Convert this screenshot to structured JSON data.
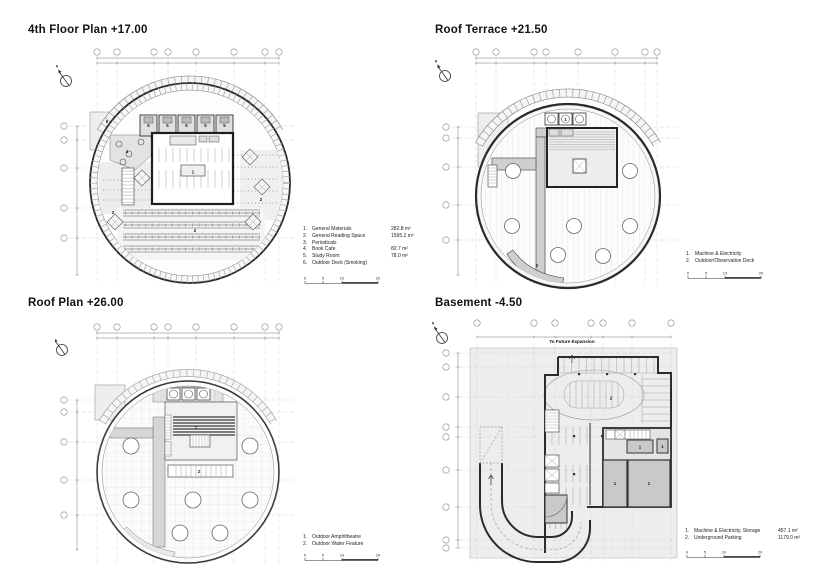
{
  "north": {
    "label": "N"
  },
  "plans": [
    {
      "title": "4th Floor Plan +17.00",
      "legend": [
        {
          "num": "1.",
          "label": "General Materials",
          "area": "282.8 m²"
        },
        {
          "num": "2.",
          "label": "General Reading Space",
          "area": "1595.2 m²"
        },
        {
          "num": "3.",
          "label": "Periodicals",
          "area": ""
        },
        {
          "num": "4.",
          "label": "Book Cafe",
          "area": "82.7 m²"
        },
        {
          "num": "5.",
          "label": "Study Room",
          "area": "78.0 m²"
        },
        {
          "num": "6.",
          "label": "Outdoor Deck (Smoking)",
          "area": ""
        }
      ],
      "scale_ticks": [
        "0",
        "5",
        "10",
        "20"
      ],
      "room_labels": {
        "r1": "1",
        "r2": "2",
        "r3": "3",
        "r4": "4",
        "r5": "5",
        "r6": "6"
      }
    },
    {
      "title": "Roof Terrace +21.50",
      "legend": [
        {
          "num": "1.",
          "label": "Machine & Electricity",
          "area": ""
        },
        {
          "num": "2.",
          "label": "Outdoor/Observation Deck",
          "area": ""
        }
      ],
      "scale_ticks": [
        "0",
        "5",
        "10",
        "20"
      ],
      "room_labels": {
        "r1": "1",
        "r2": "2"
      }
    },
    {
      "title": "Roof Plan +26.00",
      "legend": [
        {
          "num": "1.",
          "label": "Outdoor Amphitheatre",
          "area": ""
        },
        {
          "num": "2.",
          "label": "Outdoor Water Feature",
          "area": ""
        }
      ],
      "scale_ticks": [
        "0",
        "5",
        "10",
        "20"
      ],
      "room_labels": {
        "r1": "1",
        "r2": "2"
      }
    },
    {
      "title": "Basement -4.50",
      "note": "To Future Expansion",
      "legend": [
        {
          "num": "1.",
          "label": "Machine & Electricity, Storage",
          "area": "457.1 m²"
        },
        {
          "num": "2.",
          "label": "Underground Parking",
          "area": "1179.0 m²"
        }
      ],
      "scale_ticks": [
        "0",
        "5",
        "10",
        "20"
      ],
      "room_labels": {
        "r1": "1",
        "r2": "2"
      }
    }
  ]
}
